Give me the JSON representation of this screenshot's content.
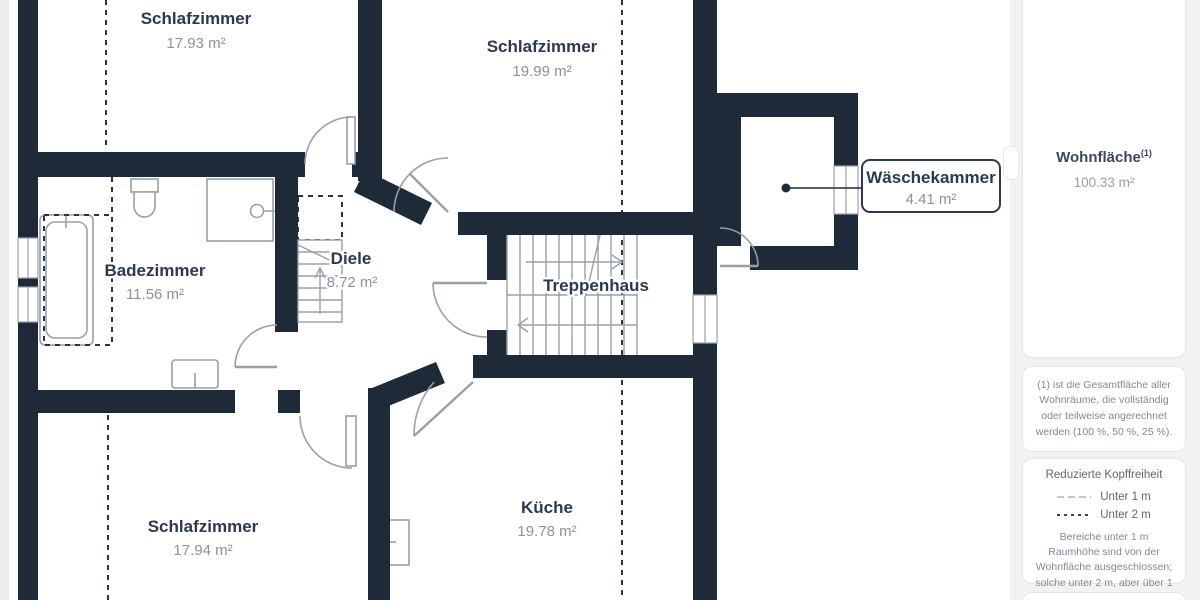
{
  "plan": {
    "rooms": [
      {
        "name": "Schlafzimmer",
        "area": "17.93 m²"
      },
      {
        "name": "Schlafzimmer",
        "area": "19.99 m²"
      },
      {
        "name": "Wäschekammer",
        "area": "4.41 m²"
      },
      {
        "name": "Badezimmer",
        "area": "11.56 m²"
      },
      {
        "name": "Diele",
        "area": "8.72 m²"
      },
      {
        "name": "Treppenhaus",
        "area": ""
      },
      {
        "name": "Küche",
        "area": "19.78 m²"
      },
      {
        "name": "Schlafzimmer",
        "area": "17.94 m²"
      }
    ],
    "colors": {
      "wall": "#1f2a38",
      "fixture_line": "#98a0a8",
      "label_text": "#2d3a4d",
      "area_text": "#8a929c",
      "dash_dark": "#2a3542",
      "dash_light": "#c3c9cf"
    }
  },
  "sidebar": {
    "summary": {
      "title": "Wohnfläche",
      "footnote_marker": "(1)",
      "value": "100.33 m²"
    },
    "footnote": "(1) ist die Gesamtfläche aller Wohnräume, die vollständig oder teilweise angerechnet werden (100 %, 50 %, 25 %).",
    "legend": {
      "title": "Reduzierte Kopffreiheit",
      "items": [
        {
          "label": "Unter 1 m"
        },
        {
          "label": "Unter 2 m"
        }
      ],
      "note": "Bereiche unter 1 m Raumhöhe sind von der Wohnfläche ausgeschlossen; solche unter 2 m, aber über 1 m, zählen als 50% der Wohnfläche"
    }
  }
}
